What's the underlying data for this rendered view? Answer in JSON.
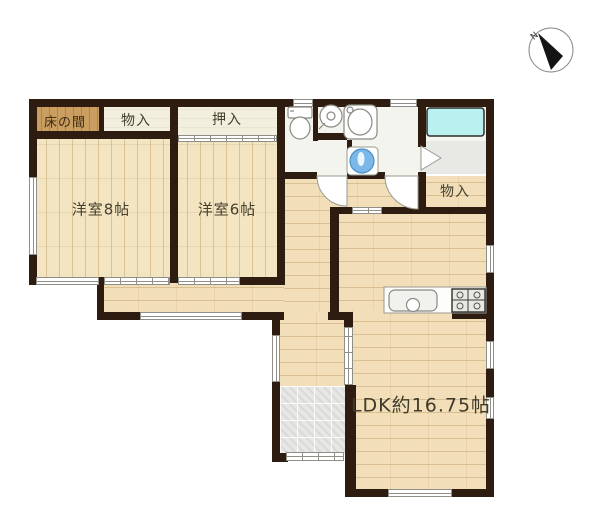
{
  "title": "floor-plan",
  "compass": {
    "north_label": "N"
  },
  "rooms": {
    "tokonoma": "床の間",
    "closet_top_left": "物入",
    "oshiire": "押入",
    "western_room_8": "洋室8帖",
    "western_room_6": "洋室6帖",
    "closet_right": "物入",
    "ldk": "LDK約16.75帖"
  },
  "fixtures": [
    "toilet",
    "round-basin",
    "washing-machine",
    "vanity-basin",
    "bathtub",
    "kitchen-sink",
    "kitchen-stove",
    "compass"
  ],
  "colors": {
    "wall": "#2e1c10",
    "wood_floor": "#f2dfba",
    "closet_fill": "#f2efde",
    "tokonoma_wood": "#c99e60",
    "bathtub_cyan": "#b9f1f1",
    "basin_blue": "#79b8e8",
    "entry_tile": "#e7e7e5",
    "label_text": "#45412f"
  }
}
